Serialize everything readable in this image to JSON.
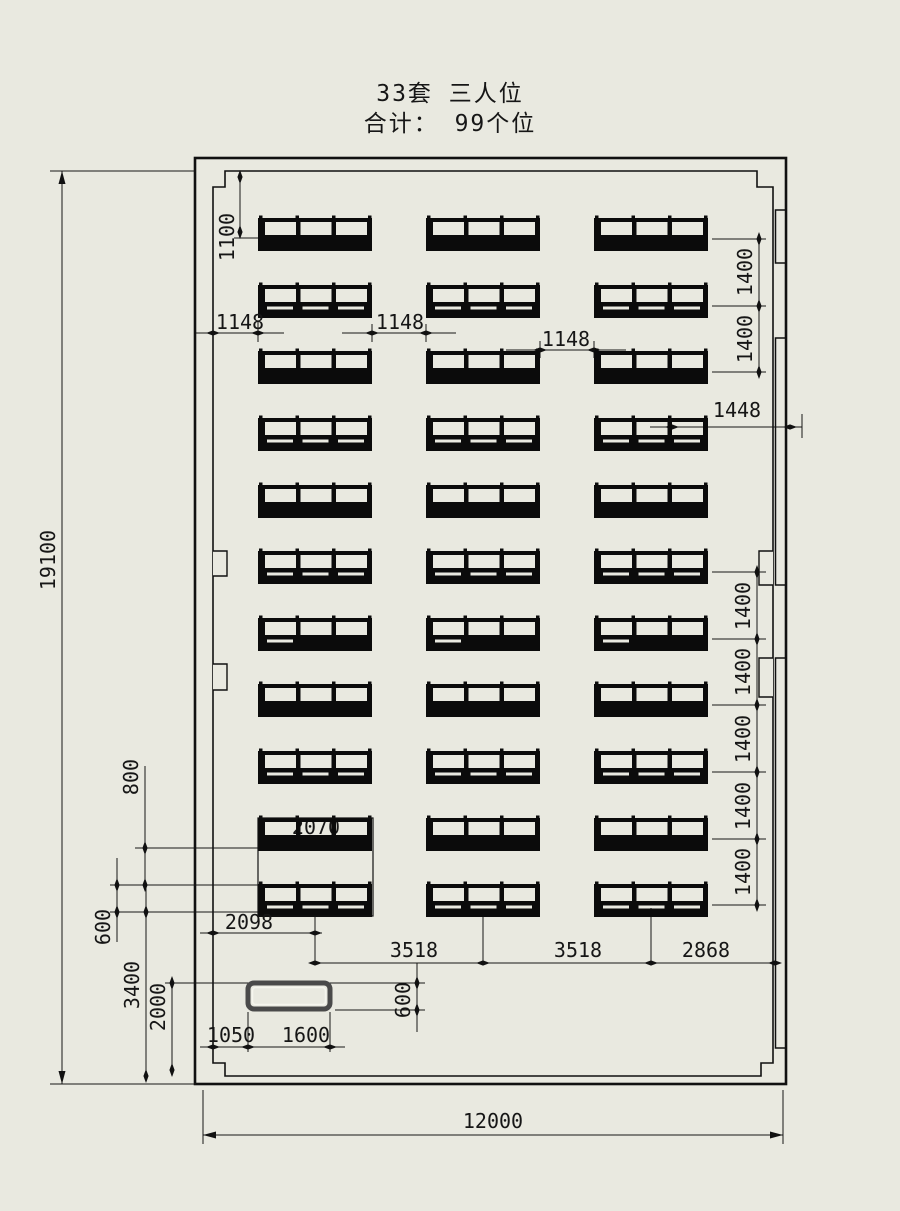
{
  "title": {
    "line1": "33套 三人位",
    "line2": "合计： 99个位"
  },
  "layout": {
    "sets": 33,
    "unit_label": "三人位",
    "rows": 11,
    "columns": 3,
    "seats_per_set": 3,
    "total_seats": 99
  },
  "dimensions": {
    "room_height": "19100",
    "room_width": "12000",
    "top_gap": "1100",
    "right_top_1400": [
      "1400",
      "1400"
    ],
    "right_bottom_1400": [
      "1400",
      "1400",
      "1400",
      "1400",
      "1400"
    ],
    "right_aisle": "1448",
    "col_gap_1": "1148",
    "col_gap_2": "1148",
    "col_gap_3": "1148",
    "left_800": "800",
    "left_600": "600",
    "left_3400": "3400",
    "left_2000": "2000",
    "box_2070": "2070",
    "bottom_2098": "2098",
    "bottom_3518_1": "3518",
    "bottom_3518_2": "3518",
    "bottom_2868": "2868",
    "podium_600": "600",
    "podium_1050": "1050",
    "podium_1600": "1600"
  },
  "colors": {
    "background": "#e9e9e0",
    "line": "#111111",
    "unit_fill": "#0b0b0b",
    "podium_border": "#4a4a4a"
  }
}
